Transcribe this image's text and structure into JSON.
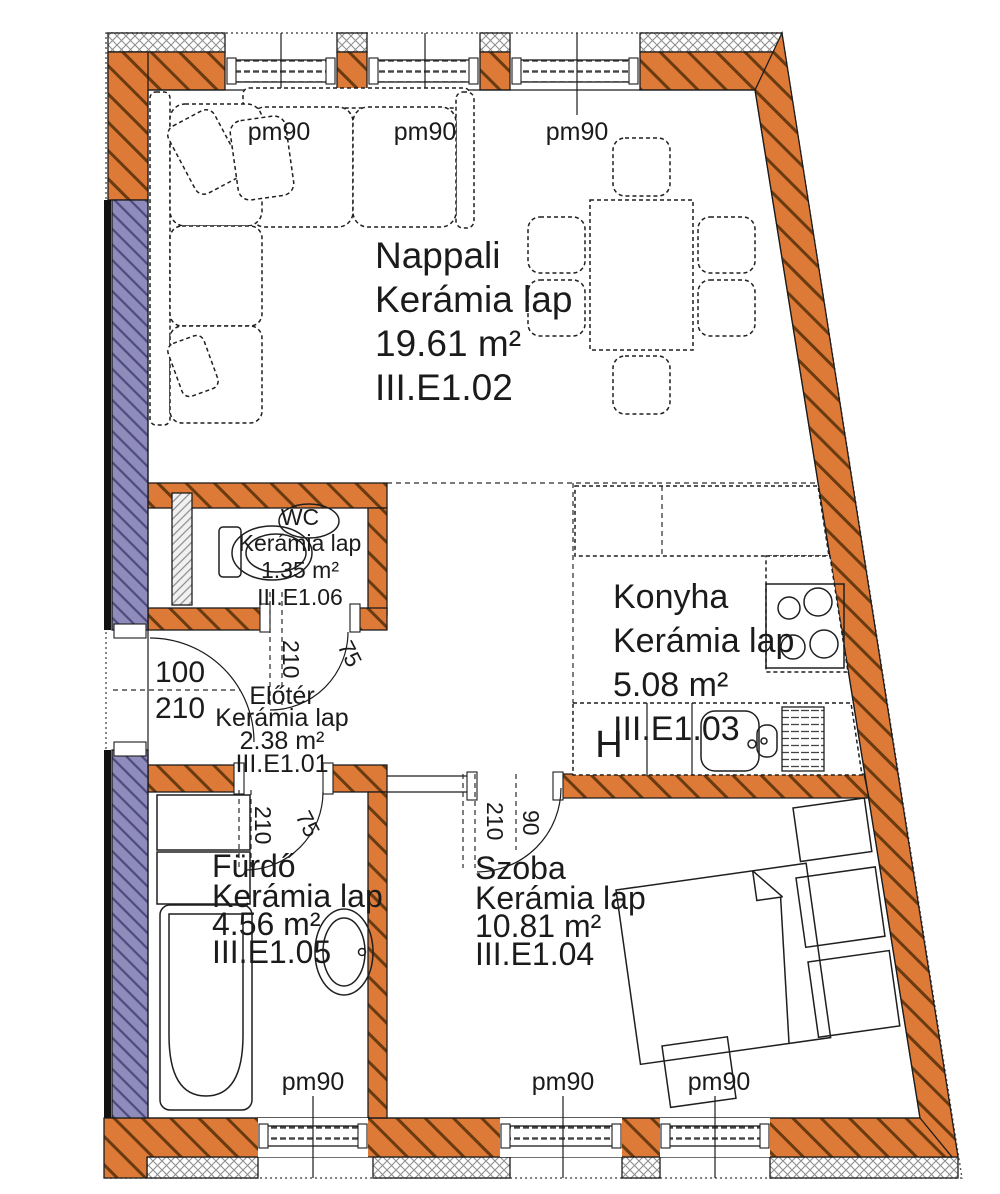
{
  "plan": {
    "rooms": {
      "nappali": {
        "name": "Nappali",
        "floor": "Kerámia lap",
        "area": "19.61 m²",
        "code": "III.E1.02"
      },
      "wc": {
        "name": "WC",
        "floor": "Kerámia lap",
        "area": "1.35 m²",
        "code": "III.E1.06"
      },
      "konyha": {
        "name": "Konyha",
        "floor": "Kerámia lap",
        "area": "5.08 m²",
        "code": "III.E1.03"
      },
      "eloter": {
        "name": "Előtér",
        "floor": "Kerámia lap",
        "area": "2.38 m²",
        "code": "III.E1.01"
      },
      "furdo": {
        "name": "Fürdő",
        "floor": "Kerámia lap",
        "area": "4.56 m²",
        "code": "III.E1.05"
      },
      "szoba": {
        "name": "Szoba",
        "floor": "Kerámia lap",
        "area": "10.81 m²",
        "code": "III.E1.04"
      }
    },
    "labels": {
      "parapet": "pm90",
      "fridge": "H"
    },
    "dims": {
      "entry": {
        "width": "100",
        "height": "210"
      },
      "wc_door": {
        "width": "75",
        "height": "210"
      },
      "furdo_door": {
        "width": "75",
        "height": "210"
      },
      "szoba_door": {
        "width": "90",
        "height": "210"
      }
    },
    "colors": {
      "wall_fill": "#de7a37",
      "wall_hatch": "#6a3a10",
      "insulation_fill": "#8f8cbb",
      "insulation_hatch": "#4d4b7d",
      "outline": "#1c1c1c"
    }
  }
}
